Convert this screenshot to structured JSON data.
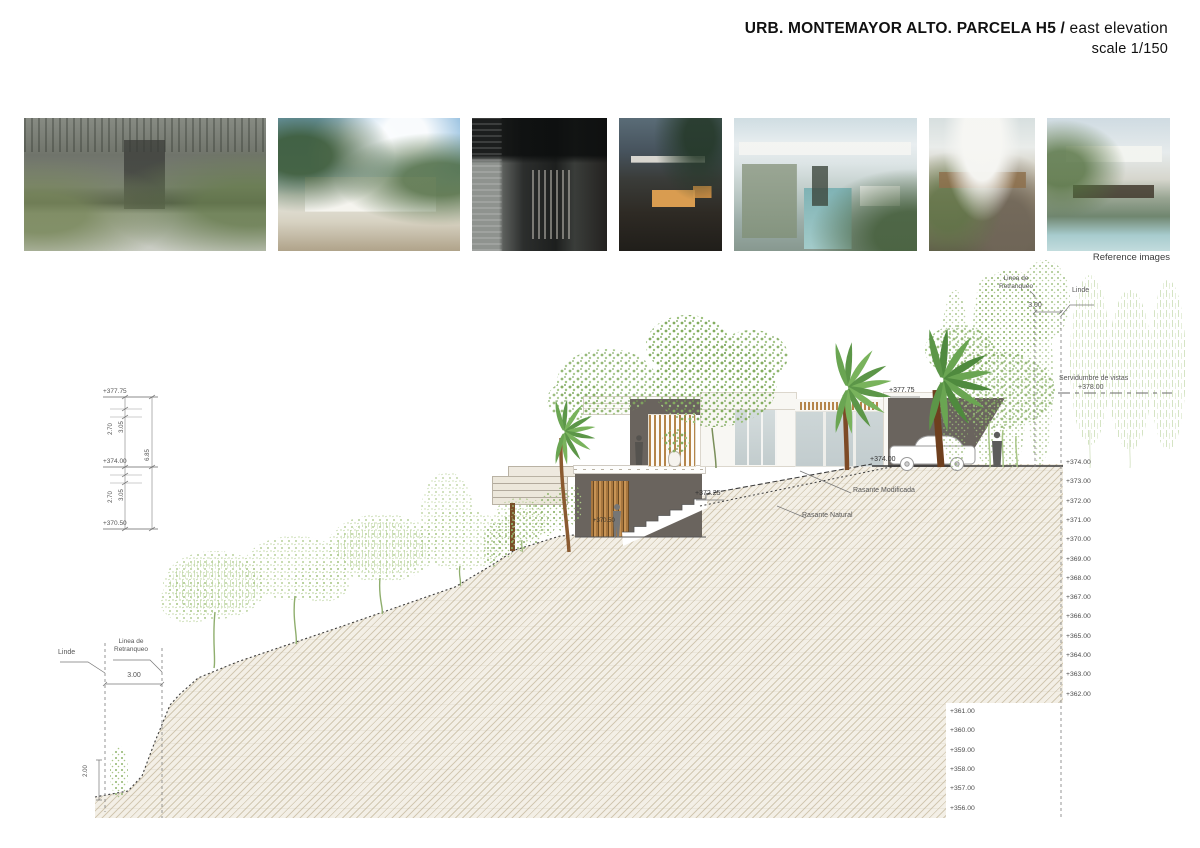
{
  "header": {
    "title_bold": "URB. MONTEMAYOR ALTO. PARCELA H5",
    "title_sep": " / ",
    "title_regular": "east elevation",
    "scale": "scale 1/150"
  },
  "reference": {
    "caption": "Reference images",
    "images": [
      {
        "name": "courtyard-pergola-entrance"
      },
      {
        "name": "white-pavilion-palms"
      },
      {
        "name": "dark-stone-entrance"
      },
      {
        "name": "timber-house-dusk"
      },
      {
        "name": "stone-wall-pool-car"
      },
      {
        "name": "curved-roof-garden"
      },
      {
        "name": "curved-roof-pool-villa"
      }
    ]
  },
  "annotations": {
    "linde_top": "Linde",
    "retranqueo_top_l1": "Linea de",
    "retranqueo_top_l2": "Retranqueo",
    "dim_top": "3.00",
    "servidumbre": "Servidumbre de vistas",
    "servidumbre_level": "+378.00",
    "rasante_modificada": "Rasante Modificada",
    "rasante_natural": "Rasante Natural",
    "level_372_25": "+372.25",
    "level_374_car": "+374.00",
    "level_377_roof": "+377.75",
    "level_370_door": "+370.50",
    "linde_bottom": "Linde",
    "retranqueo_bottom_l1": "Linea de",
    "retranqueo_bottom_l2": "Retranqueo",
    "dim_bottom": "3.00",
    "tree_height": "2.00",
    "left_chain": {
      "top": "+377.75",
      "mid": "+374.00",
      "bottom": "+370.50",
      "dims": {
        "upper_a": "3.05",
        "upper_b": "2.70",
        "total": "6.85",
        "lower_a": "3.05",
        "lower_b": "2.70"
      }
    }
  },
  "elevation_scale": {
    "column1": [
      "+374.00",
      "+373.00",
      "+372.00",
      "+371.00",
      "+370.00",
      "+369.00",
      "+368.00",
      "+367.00",
      "+366.00",
      "+365.00",
      "+364.00",
      "+363.00",
      "+362.00"
    ],
    "column2": [
      "+361.00",
      "+360.00",
      "+359.00",
      "+358.00",
      "+357.00",
      "+356.00"
    ]
  },
  "colors": {
    "dark_wall": "#6a645e",
    "wood": "#b5854a",
    "hatch_bg": "#f3efe6",
    "hatch_line": "#d2c8b2",
    "glass": "#cdd6d7",
    "green_light": "#a9c687",
    "green_mid": "#8fb46d",
    "palm_green": "#5c9648",
    "trunk_brown": "#8a5a30",
    "line_dark": "#3c3c3c"
  }
}
